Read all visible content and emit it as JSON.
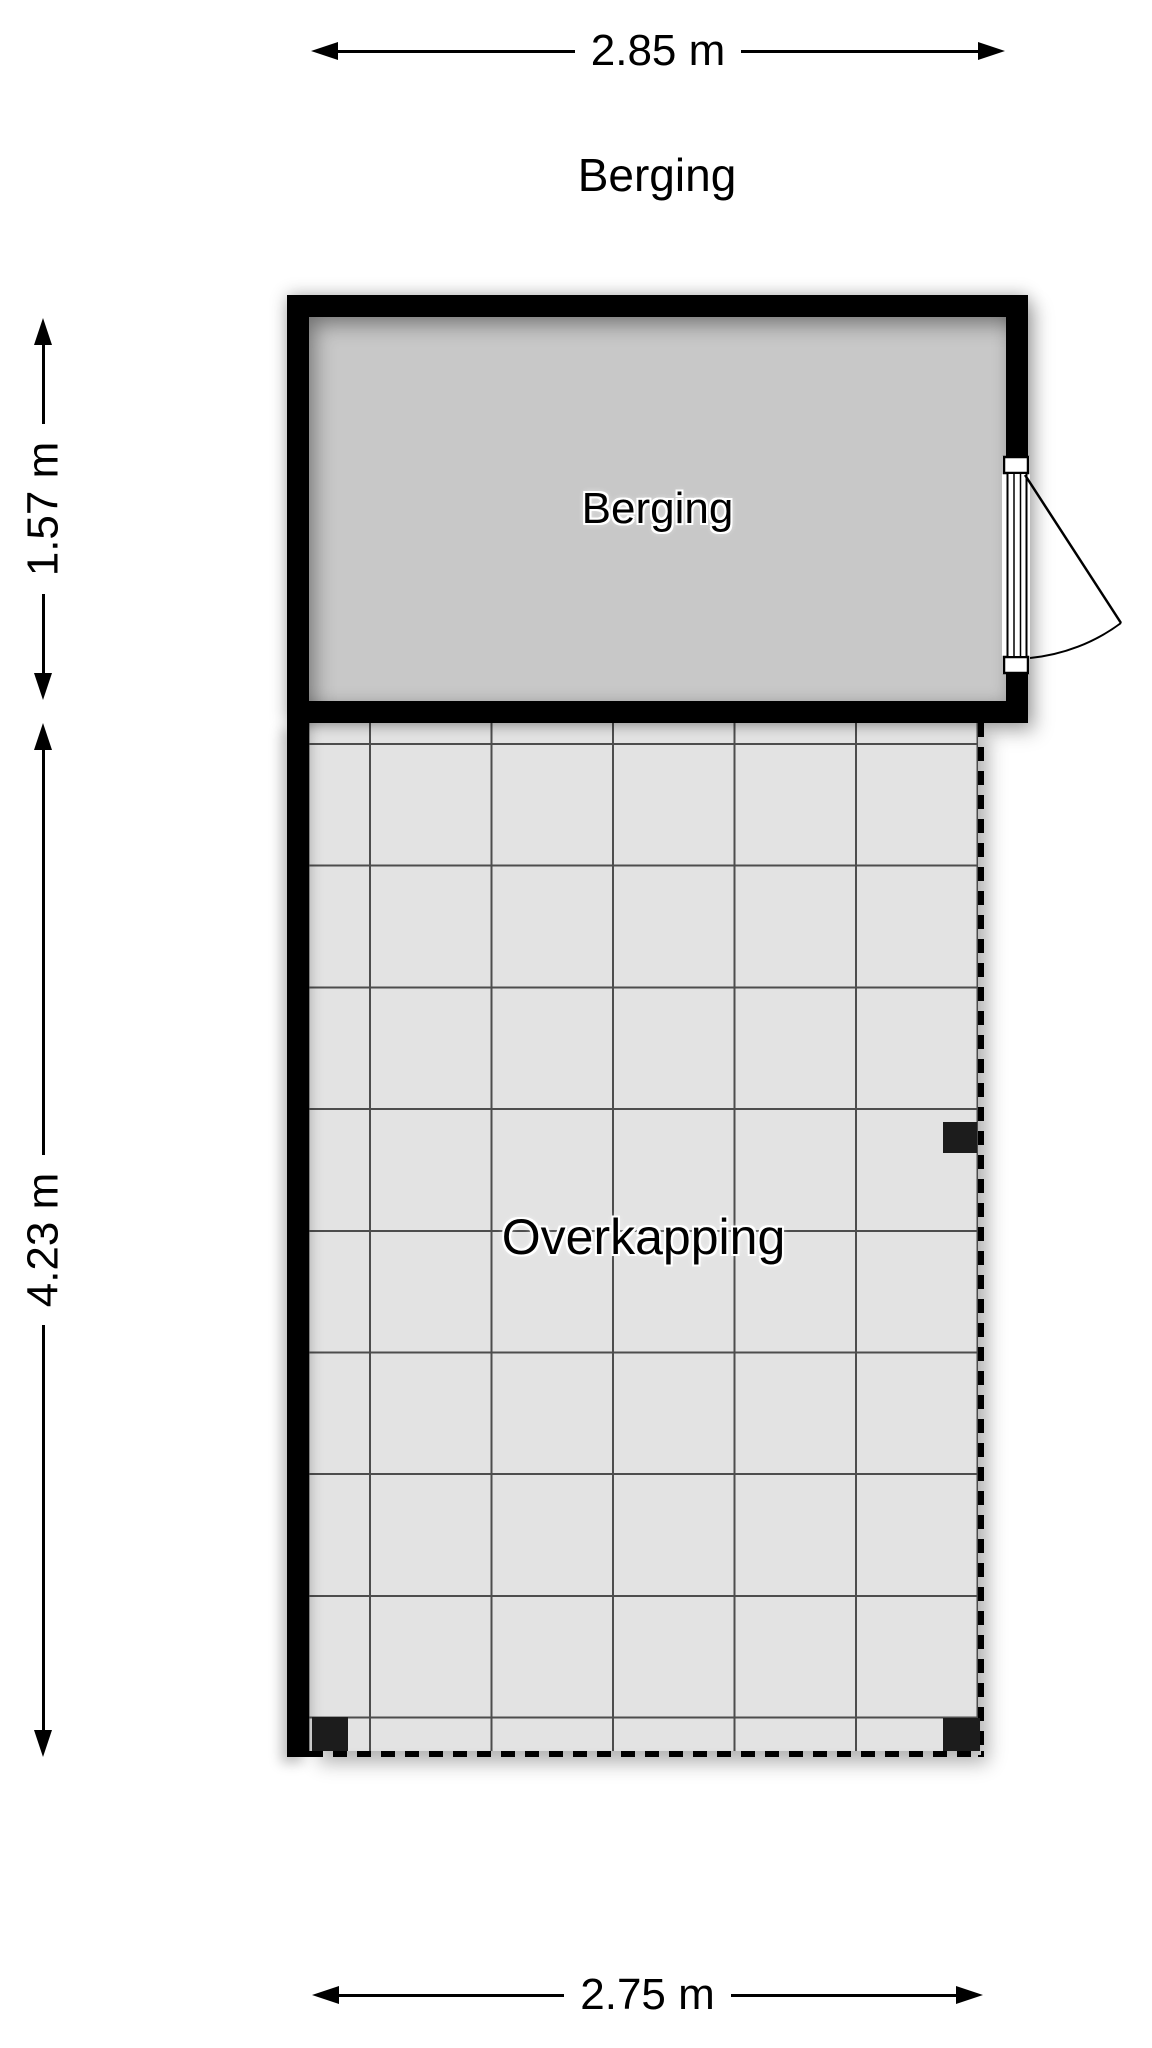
{
  "plan": {
    "title": "Berging",
    "rooms": [
      {
        "name": "Berging",
        "type": "room"
      },
      {
        "name": "Overkapping",
        "type": "covered-area"
      }
    ],
    "dimensions": {
      "berging_width": "2.85 m",
      "berging_depth": "1.57 m",
      "overkapping_depth": "4.23 m",
      "overkapping_width": "2.75 m"
    },
    "colors": {
      "wall": "#000000",
      "berging_floor": "#c8c8c8",
      "overkapping_floor": "#e3e3e3",
      "grid_line": "#4d4d4d",
      "dashed_edge": "#000000",
      "post": "#1c1c1c",
      "text": "#000000",
      "background": "#ffffff"
    }
  }
}
